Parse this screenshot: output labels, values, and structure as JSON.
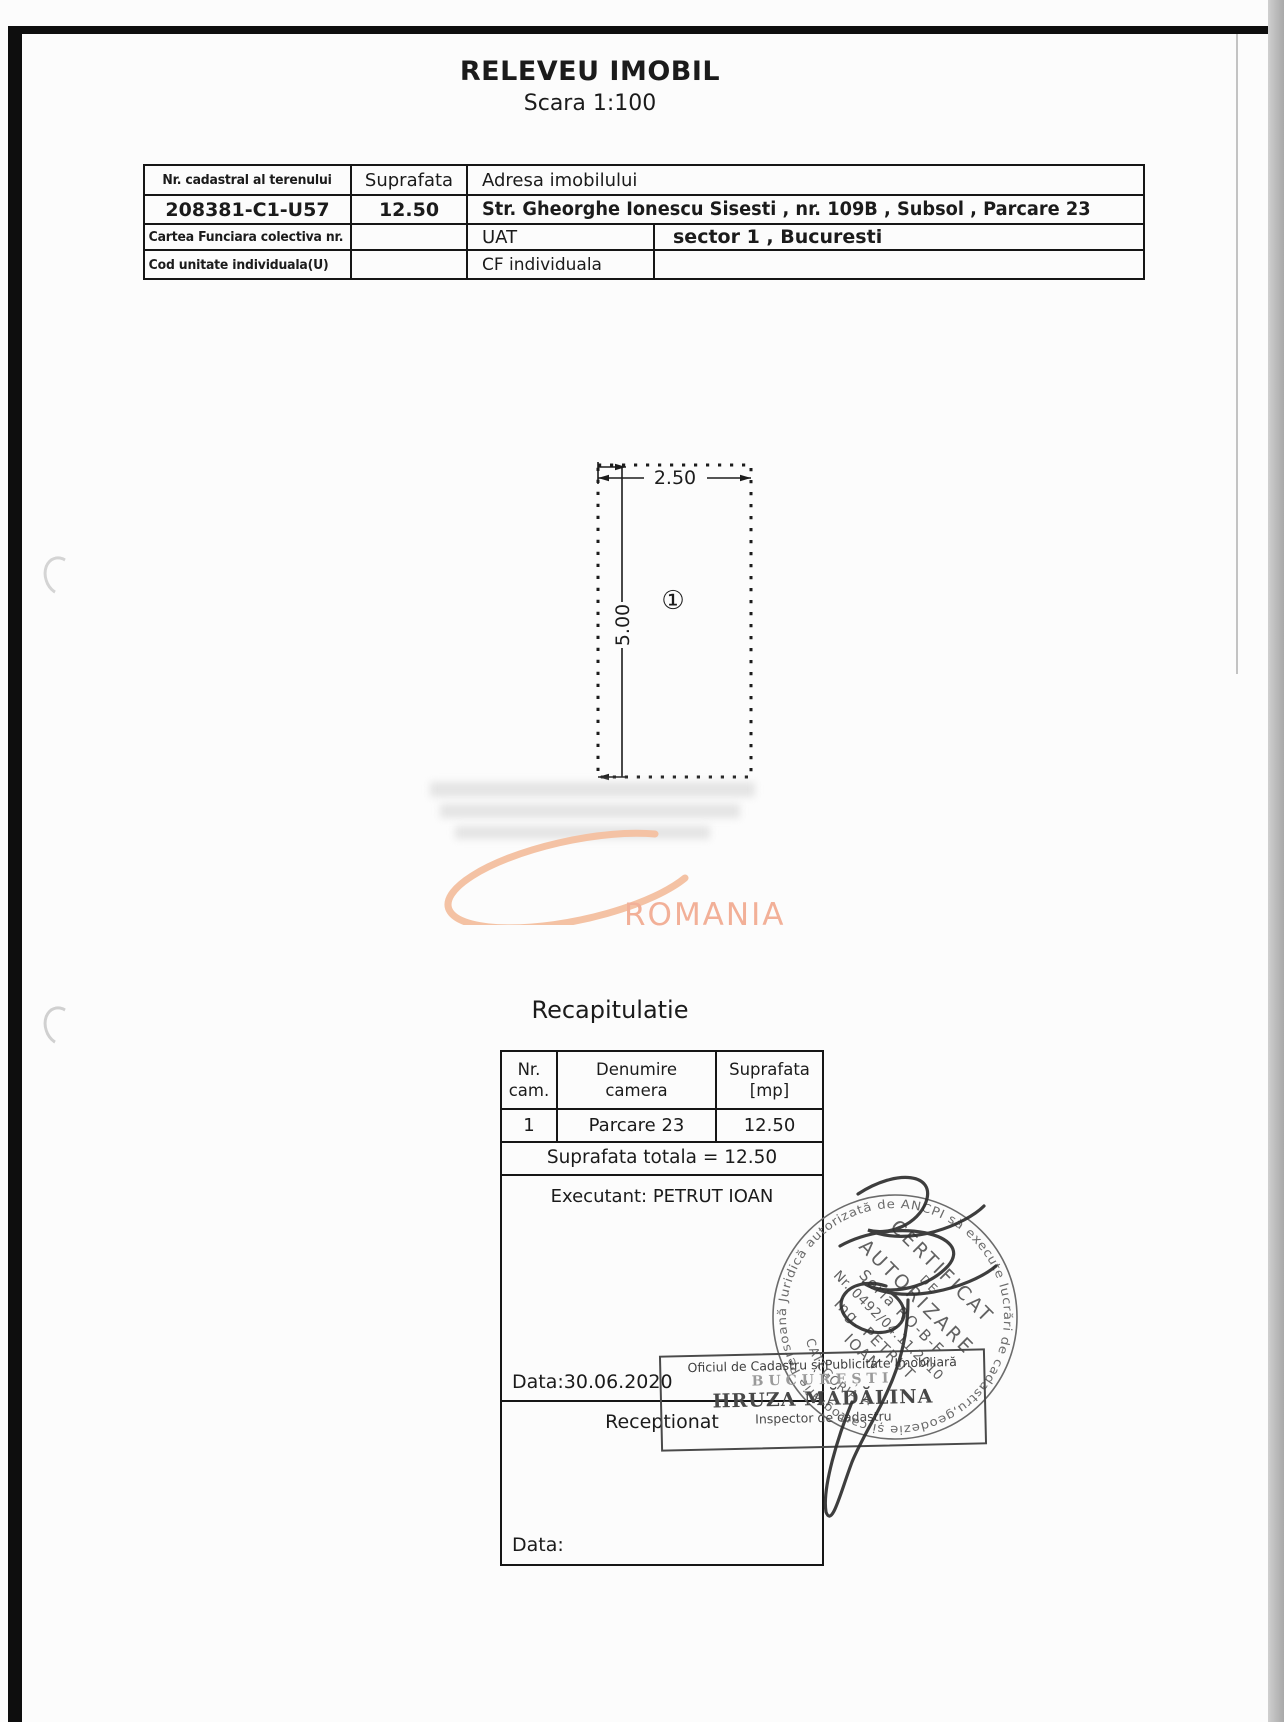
{
  "document": {
    "title": "RELEVEU IMOBIL",
    "scale": "Scara 1:100"
  },
  "info_table": {
    "headers": {
      "cadastral": "Nr. cadastral al terenului",
      "area": "Suprafata",
      "address": "Adresa imobilului"
    },
    "values": {
      "cadastral": "208381-C1-U57",
      "area": "12.50",
      "address": "Str. Gheorghe Ionescu Sisesti , nr. 109B , Subsol , Parcare 23"
    },
    "row3": {
      "label": "Cartea Funciara colectiva nr.",
      "uat_label": "UAT",
      "uat_value": "sector 1 , Bucuresti"
    },
    "row4": {
      "label": "Cod unitate individuala(U)",
      "cf_label": "CF individuala",
      "cf_value": ""
    }
  },
  "plan": {
    "width_label": "2.50",
    "height_label": "5.00",
    "room_label": "①"
  },
  "watermark": {
    "text": "ROMANIA",
    "orange": "#f2b098"
  },
  "recap": {
    "title": "Recapitulatie",
    "header": {
      "nr1": "Nr.",
      "nr2": "cam.",
      "den1": "Denumire",
      "den2": "camera",
      "sup1": "Suprafata",
      "sup2": "[mp]"
    },
    "row": {
      "nr": "1",
      "name": "Parcare 23",
      "area": "12.50"
    },
    "total": "Suprafata totala = 12.50",
    "executant": "Executant: PETRUT IOAN",
    "exec_date": "Data:30.06.2020",
    "receptionat": "Receptionat",
    "recv_date": "Data:"
  },
  "round_stamp": {
    "ring_text": "Persoană Juridică autorizată de ANCPI să execute lucrări de cadastru,geodezie și cartografie",
    "category": "CATEGORIA A.",
    "line1": "CERTIFICAT",
    "line2": "DE",
    "line3": "AUTORIZARE",
    "line4": "Seria RO-B-F",
    "line5": "Nr. 0492/04.11.2010",
    "line6": "Ing. PETRUT",
    "line7": "IOAN"
  },
  "rect_stamp": {
    "line1": "Oficiul de Cadastru și Publicitate Imobiliară",
    "line2": "BUCUREȘTI",
    "line3": "HRUZA MĂDĂLINA",
    "line4": "Inspector de cadastru"
  }
}
